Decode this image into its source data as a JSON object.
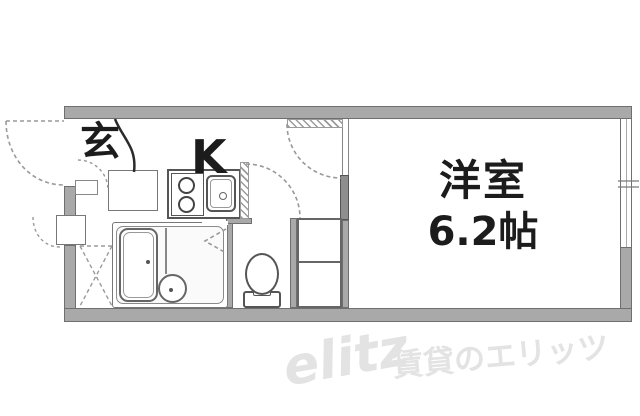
{
  "floor_plan": {
    "rooms": {
      "entrance_label": "玄",
      "kitchen_label": "K",
      "main_room_label": "洋室",
      "main_room_size": "6.2帖"
    },
    "fixtures": [
      "bathtub",
      "washbasin",
      "toilet",
      "stove",
      "sink",
      "shoe-cabinet",
      "storage-shelves",
      "meter-box",
      "laundry-space"
    ],
    "watermark": {
      "logo": "elitz",
      "caption": "賃貸のエリッツ"
    },
    "colors": {
      "wall_fill": "#a9a9a9",
      "wall_border": "#6f6f6f",
      "wall_dark": "#8e8e8e",
      "fixture_line": "#555555",
      "dashed_line": "#999999",
      "label_text": "#1c1c1c",
      "watermark_gray": "#e3e3e3",
      "background": "#ffffff"
    }
  }
}
